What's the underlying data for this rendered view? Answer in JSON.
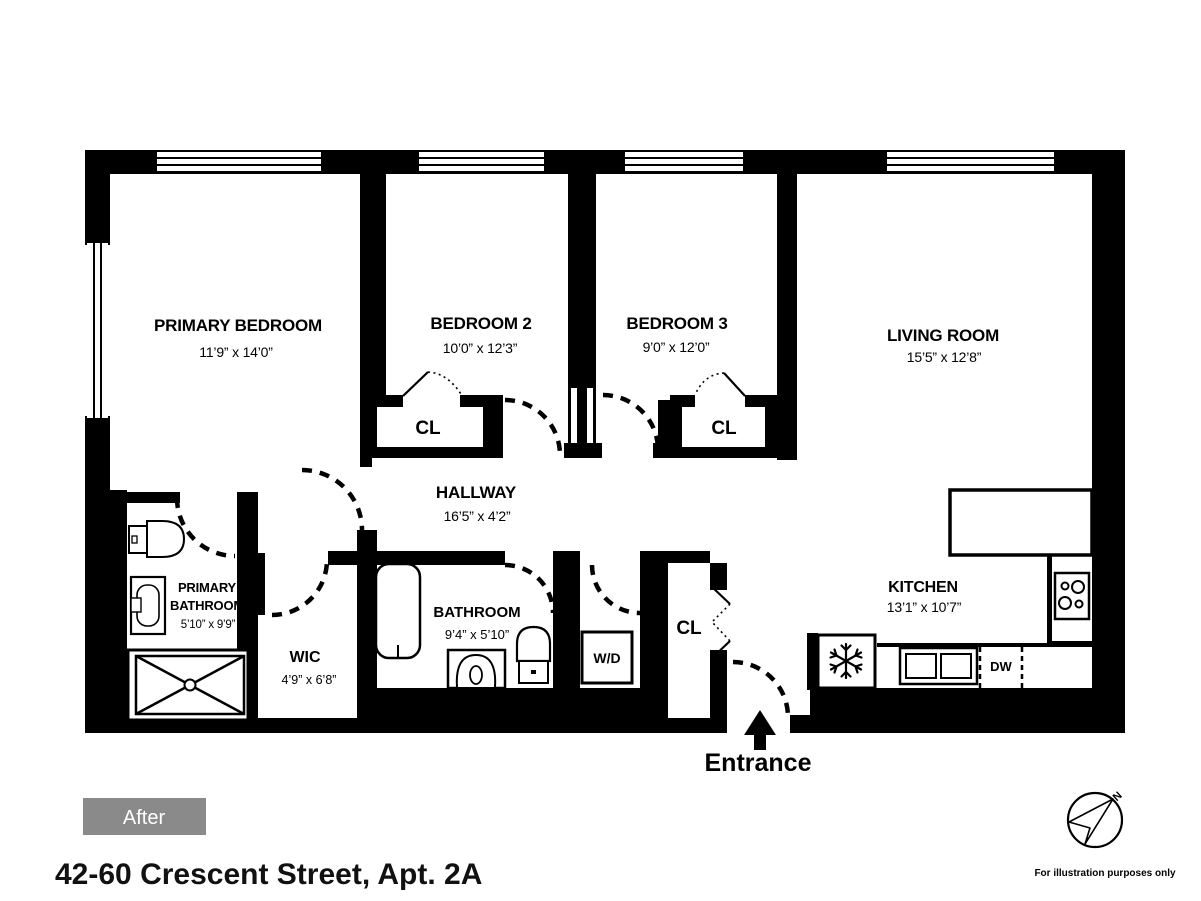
{
  "floorplan": {
    "rooms": {
      "primary_bedroom": {
        "name": "PRIMARY BEDROOM",
        "dims": "11’9” x 14’0”"
      },
      "bedroom2": {
        "name": "BEDROOM 2",
        "dims": "10’0” x 12’3”"
      },
      "bedroom3": {
        "name": "BEDROOM 3",
        "dims": "9’0” x 12’0”"
      },
      "living_room": {
        "name": "LIVING ROOM",
        "dims": "15’5” x 12’8”"
      },
      "hallway": {
        "name": "HALLWAY",
        "dims": "16’5” x 4’2”"
      },
      "primary_bathroom": {
        "name_line1": "PRIMARY",
        "name_line2": "BATHROOM",
        "dims": "5’10” x 9’9”"
      },
      "wic": {
        "name": "WIC",
        "dims": "4’9” x 6’8”"
      },
      "bathroom": {
        "name": "BATHROOM",
        "dims": "9’4” x 5’10”"
      },
      "kitchen": {
        "name": "KITCHEN",
        "dims": "13’1” x 10’7”"
      }
    },
    "labels": {
      "closet": "CL",
      "washer_dryer": "W/D",
      "dishwasher": "DW",
      "entrance": "Entrance",
      "compass_north": "N"
    }
  },
  "badge": {
    "text": "After",
    "bg_color": "#8a8a8a"
  },
  "address": "42-60 Crescent Street, Apt. 2A",
  "disclaimer": "For illustration purposes only",
  "colors": {
    "wall": "#000000",
    "background": "#ffffff"
  }
}
